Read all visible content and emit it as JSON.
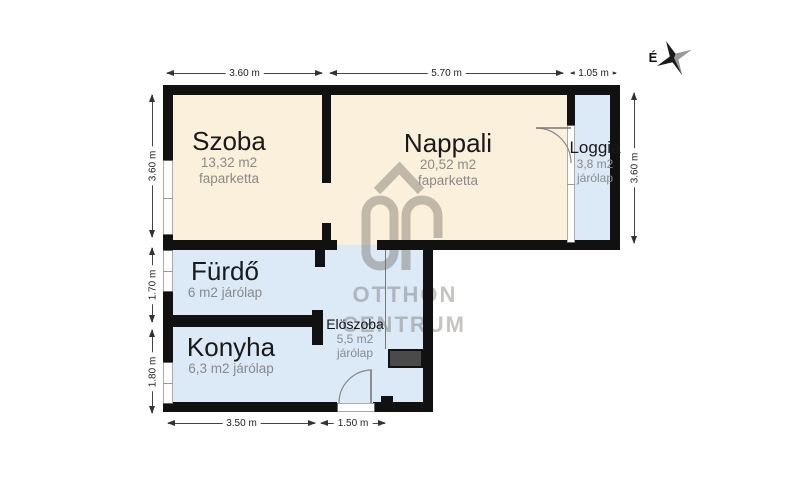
{
  "compass": {
    "north_label": "É"
  },
  "watermark": {
    "line1": "OTTHON",
    "line2": "CENTRUM"
  },
  "rooms": {
    "szoba": {
      "name": "Szoba",
      "area": "13,32 m2",
      "floor": "faparketta"
    },
    "nappali": {
      "name": "Nappali",
      "area": "20,52 m2",
      "floor": "faparketta"
    },
    "loggia": {
      "name": "Loggia",
      "area": "3,8 m2",
      "floor": "járólap"
    },
    "furdo": {
      "name": "Fürdő",
      "area": "6 m2 járólap"
    },
    "konyha": {
      "name": "Konyha",
      "area": "6,3 m2 járólap"
    },
    "eloszoba": {
      "name": "Elöszoba",
      "area": "5,5 m2",
      "floor": "járólap"
    }
  },
  "dimensions": {
    "top": [
      "3.60 m",
      "5.70 m",
      "1.05 m"
    ],
    "left": [
      "3.60 m",
      "1.70 m",
      "1.80 m"
    ],
    "right": [
      "3.60 m"
    ],
    "bottom": [
      "3.50 m",
      "1.50 m"
    ]
  },
  "colors": {
    "warm_floor": "#fbf0dc",
    "cool_floor": "#dce9f6",
    "wall": "#111111",
    "watermark": "#6a645c",
    "closet": "#4a4a4a"
  }
}
